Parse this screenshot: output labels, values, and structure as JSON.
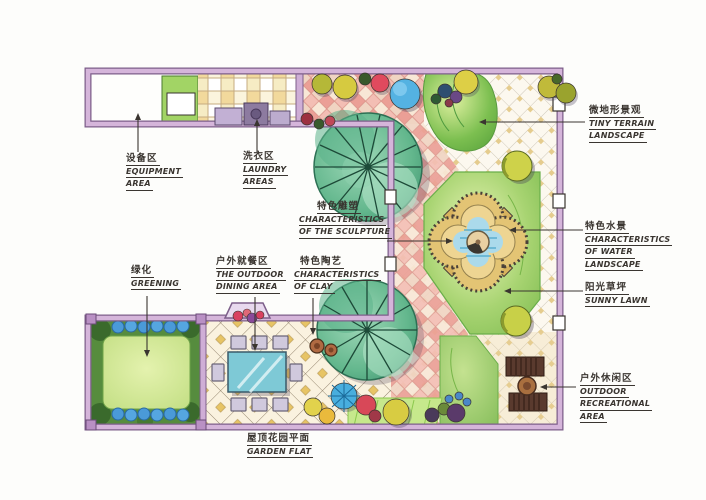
{
  "title": "Hand-drawn roof garden landscape plan",
  "labels": {
    "equipment": {
      "zh": "设备区",
      "en": [
        "EQUIPMENT",
        "AREA"
      ]
    },
    "laundry": {
      "zh": "洗衣区",
      "en": [
        "LAUNDRY",
        "AREAS"
      ]
    },
    "sculpture": {
      "zh": "特色雕塑",
      "en": [
        "CHARACTERISTICS",
        "OF THE SCULPTURE"
      ]
    },
    "tiny_terrain": {
      "zh": "微地形景观",
      "en": [
        "TINY TERRAIN",
        "LANDSCAPE"
      ]
    },
    "water": {
      "zh": "特色水景",
      "en": [
        "CHARACTERISTICS",
        "OF WATER",
        "LANDSCAPE"
      ]
    },
    "sunny_lawn": {
      "zh": "阳光草坪",
      "en": [
        "SUNNY LAWN"
      ]
    },
    "greening": {
      "zh": "绿化",
      "en": [
        "GREENING"
      ]
    },
    "dining": {
      "zh": "户外就餐区",
      "en": [
        "THE OUTDOOR",
        "DINING AREA"
      ]
    },
    "clay": {
      "zh": "特色陶艺",
      "en": [
        "CHARACTERISTICS",
        "OF CLAY"
      ]
    },
    "recreation": {
      "zh": "户外休闲区",
      "en": [
        "OUTDOOR",
        "RECREATIONAL",
        "AREA"
      ]
    },
    "garden_flat": {
      "zh": "屋顶花园平面",
      "en": [
        "GARDEN FLAT"
      ]
    }
  },
  "colors": {
    "ink": "#3a3530",
    "wall_fill": "#d5b5da",
    "wall_edge": "#7d5f8a",
    "lawn_green": "#9acb6a",
    "tree_teal": "#63b78d",
    "water_blue": "#abdaeb",
    "paving_pink": "#f3beb4",
    "paving_cream": "#fbf7ee",
    "accent_gold": "#e7c465",
    "bench_brown": "#5a3a2e"
  }
}
